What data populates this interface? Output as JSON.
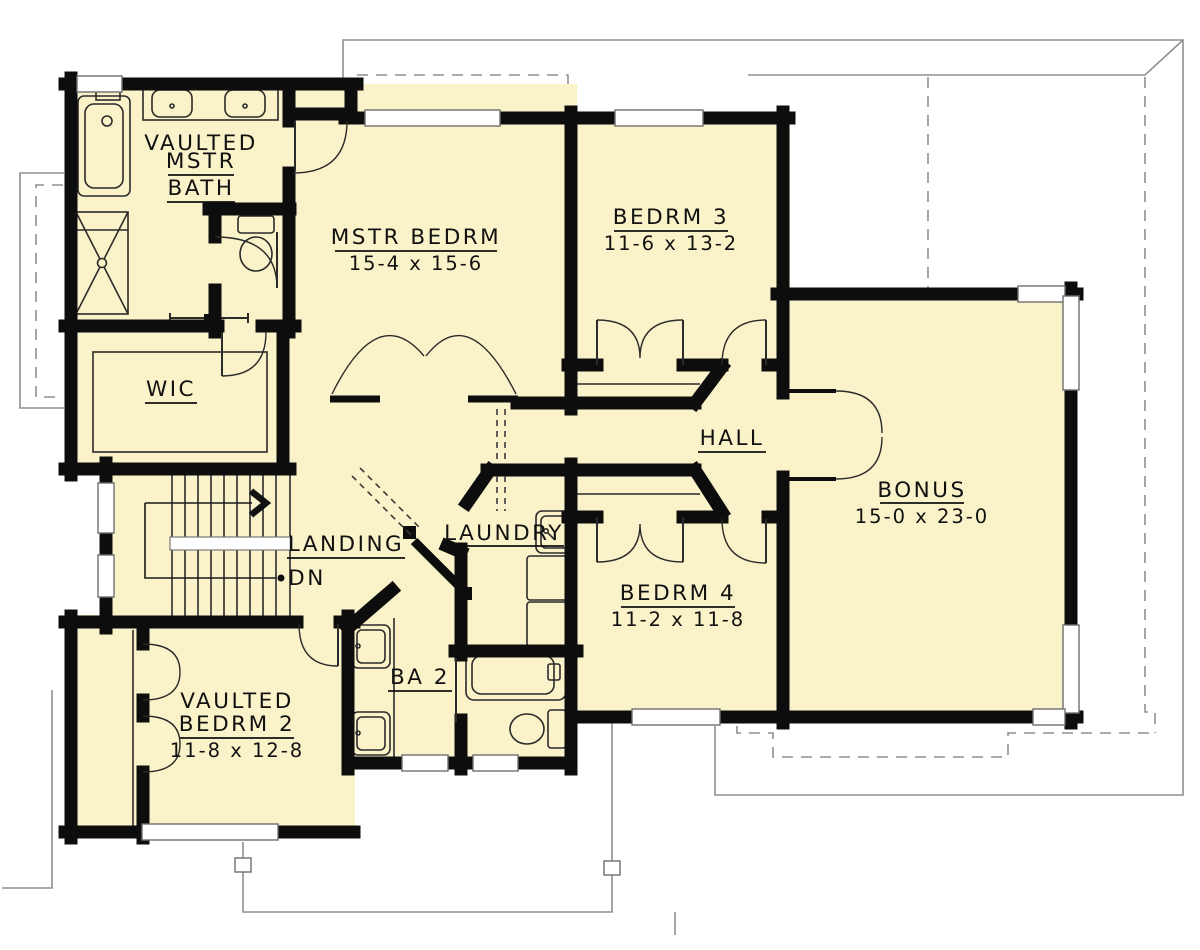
{
  "colors": {
    "room_fill": "#faf3c9",
    "wall": "#0d0d0d",
    "fixture_line": "#2b2b2b",
    "below_floor_line": "#8f8f8f",
    "text": "#111111",
    "paper": "#ffffff"
  },
  "rooms": {
    "mstr_bath": {
      "line1": "VAULTED",
      "line2": "MSTR",
      "line3": "BATH"
    },
    "mstr_bedrm": {
      "name": "MSTR BEDRM",
      "dims": "15-4 x 15-6"
    },
    "bedrm3": {
      "name": "BEDRM 3",
      "dims": "11-6 x 13-2"
    },
    "wic": {
      "name": "WIC"
    },
    "hall": {
      "name": "HALL"
    },
    "bonus": {
      "name": "BONUS",
      "dims": "15-0 x 23-0"
    },
    "landing": {
      "name": "LANDING"
    },
    "laundry": {
      "name": "LAUNDRY"
    },
    "bedrm4": {
      "name": "BEDRM 4",
      "dims": "11-2 x 11-8"
    },
    "ba2": {
      "name": "BA 2"
    },
    "bedrm2": {
      "line1": "VAULTED",
      "name": "BEDRM 2",
      "dims": "11-8 x 12-8"
    }
  },
  "stairs": {
    "down_label": "DN"
  }
}
